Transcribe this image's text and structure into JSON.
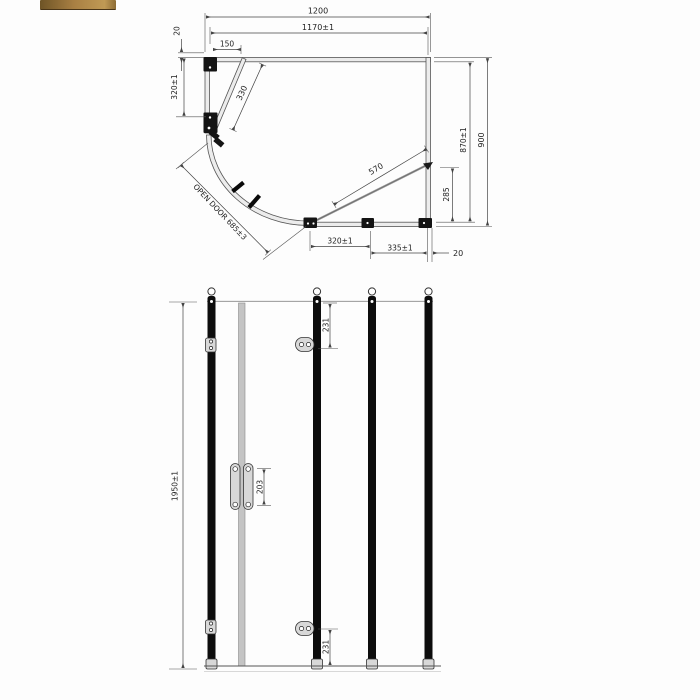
{
  "plan": {
    "dim_overall_width": "1200",
    "dim_inner_width": "1170±1",
    "dim_door_projection": "150",
    "dim_top_wall_thickness": "20",
    "dim_left_panel": "320±1",
    "dim_door_panel": "330",
    "dim_open_door": "OPEN DOOR 685±3",
    "dim_diagonal_opening": "570",
    "dim_side_opening": "285",
    "dim_inner_depth": "870±1",
    "dim_overall_depth": "900",
    "dim_bottom_panel_left": "320±1",
    "dim_bottom_panel_right": "335±1",
    "dim_right_wall_thickness": "20"
  },
  "elevation": {
    "dim_overall_height": "1950±1",
    "dim_top_hinge_offset": "231",
    "dim_handle_length": "203",
    "dim_bottom_hinge_offset": "231"
  },
  "colors": {
    "accent_bar_left": "#6e5426",
    "accent_bar_mid": "#a98043",
    "accent_bar_right": "#c09a55",
    "line": "#444444",
    "profile_black": "#0d0d0d"
  }
}
